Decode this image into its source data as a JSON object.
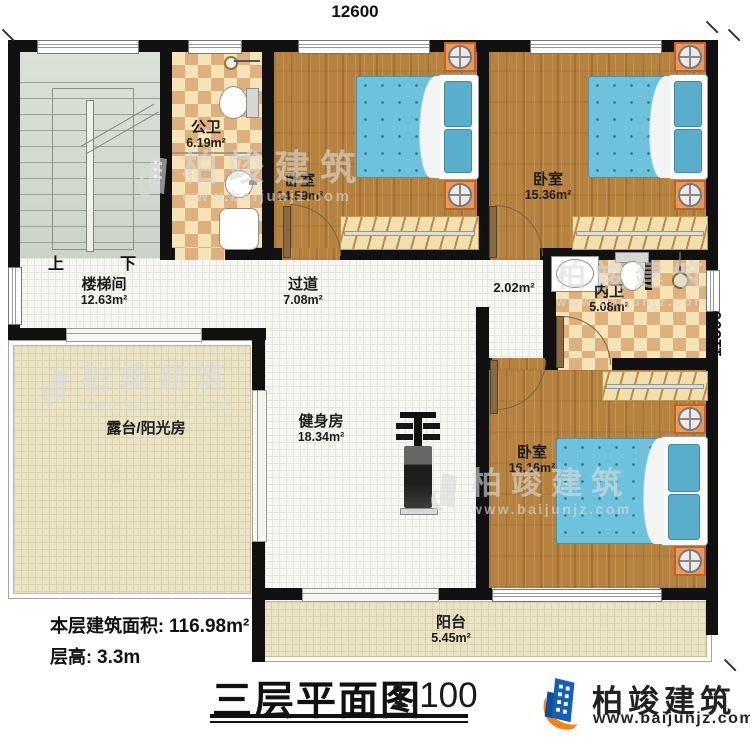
{
  "dim": {
    "top": "12600",
    "right": "11500"
  },
  "rooms": {
    "stairwell": {
      "name": "楼梯间",
      "area": "12.63m²"
    },
    "public_bath": {
      "name": "公卫",
      "area": "6.19m²"
    },
    "bedroom1": {
      "name": "卧室",
      "area": "14.59m²"
    },
    "bedroom2": {
      "name": "卧室",
      "area": "15.36m²"
    },
    "hallway": {
      "name": "过道",
      "area": "7.08m²"
    },
    "closet": {
      "area": "2.02m²"
    },
    "ensuite": {
      "name": "内卫",
      "area": "5.08m²"
    },
    "terrace": {
      "name": "露台/阳光房"
    },
    "gym": {
      "name": "健身房",
      "area": "18.34m²"
    },
    "bedroom3": {
      "name": "卧室",
      "area": "16.16m²"
    },
    "balcony": {
      "name": "阳台",
      "area": "5.45m²"
    }
  },
  "stairs": {
    "up": "上",
    "down": "下"
  },
  "footer": {
    "area_label": "本层建筑面积:",
    "area_value": "116.98m²",
    "height_label": "层高:",
    "height_value": "3.3m",
    "title": "三层平面图",
    "scale": "1:100"
  },
  "brand": {
    "name": "柏竣建筑",
    "url": "www.baijunjz.com"
  },
  "colors": {
    "wall": "#111111",
    "wood_floor": "#b5823f",
    "tile_checker": "#ddb07e",
    "bed_blue": "#6fc2dc",
    "nightstand_orange": "#e79a60",
    "logo_blue": "#1660b3",
    "logo_orange": "#f08519"
  }
}
